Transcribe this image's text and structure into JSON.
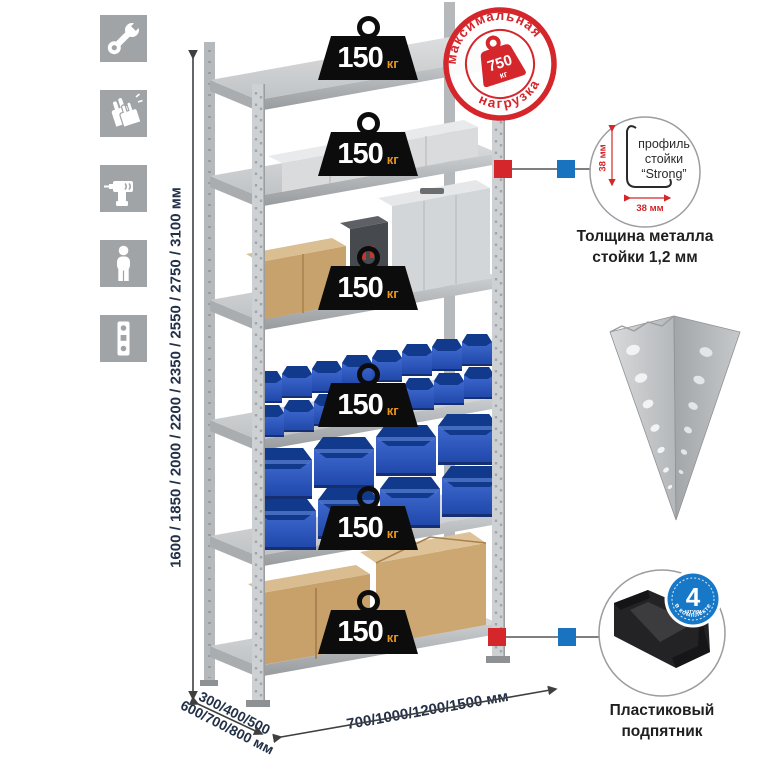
{
  "colors": {
    "accent_red": "#d5262b",
    "accent_blue": "#1a73be",
    "badge_black": "#0c0c0d",
    "kg_orange": "#e8941a",
    "navy_text": "#223048",
    "icon_gray": "#a0a4a7",
    "bin_blue": "#2e5ac4"
  },
  "left_toolbar": {
    "icons": [
      {
        "name": "wrench-icon"
      },
      {
        "name": "gloves-icon"
      },
      {
        "name": "drill-icon"
      },
      {
        "name": "person-icon"
      },
      {
        "name": "perforated-post-icon"
      }
    ]
  },
  "height_dimension": {
    "label": "1600 / 1850 / 2000 / 2200 / 2350 / 2550 / 2750 / 3100 мм"
  },
  "shelf_badges": [
    {
      "value": "150",
      "unit": "кг"
    },
    {
      "value": "150",
      "unit": "кг"
    },
    {
      "value": "150",
      "unit": "кг"
    },
    {
      "value": "150",
      "unit": "кг"
    },
    {
      "value": "150",
      "unit": "кг"
    },
    {
      "value": "150",
      "unit": "кг"
    }
  ],
  "max_load_stamp": {
    "arc_top": "максимальная",
    "arc_bottom": "нагрузка",
    "value": "750",
    "unit": "кг"
  },
  "profile_detail": {
    "line1": "профиль",
    "line2": "стойки",
    "line3": "“Strong”",
    "dim_vertical": "38 мм",
    "dim_horizontal": "38 мм",
    "caption_line1": "Толщина металла",
    "caption_line2": "стойки 1,2 мм"
  },
  "foot_detail": {
    "badge_number": "4",
    "badge_small": "штуки",
    "badge_arc": "в комплекте",
    "caption_line1": "Пластиковый",
    "caption_line2": "подпятник"
  },
  "depth_dimension": {
    "line1": "300/400/500",
    "line2": "600/700/800 мм"
  },
  "width_dimension": {
    "label": "700/1000/1200/1500 мм"
  }
}
